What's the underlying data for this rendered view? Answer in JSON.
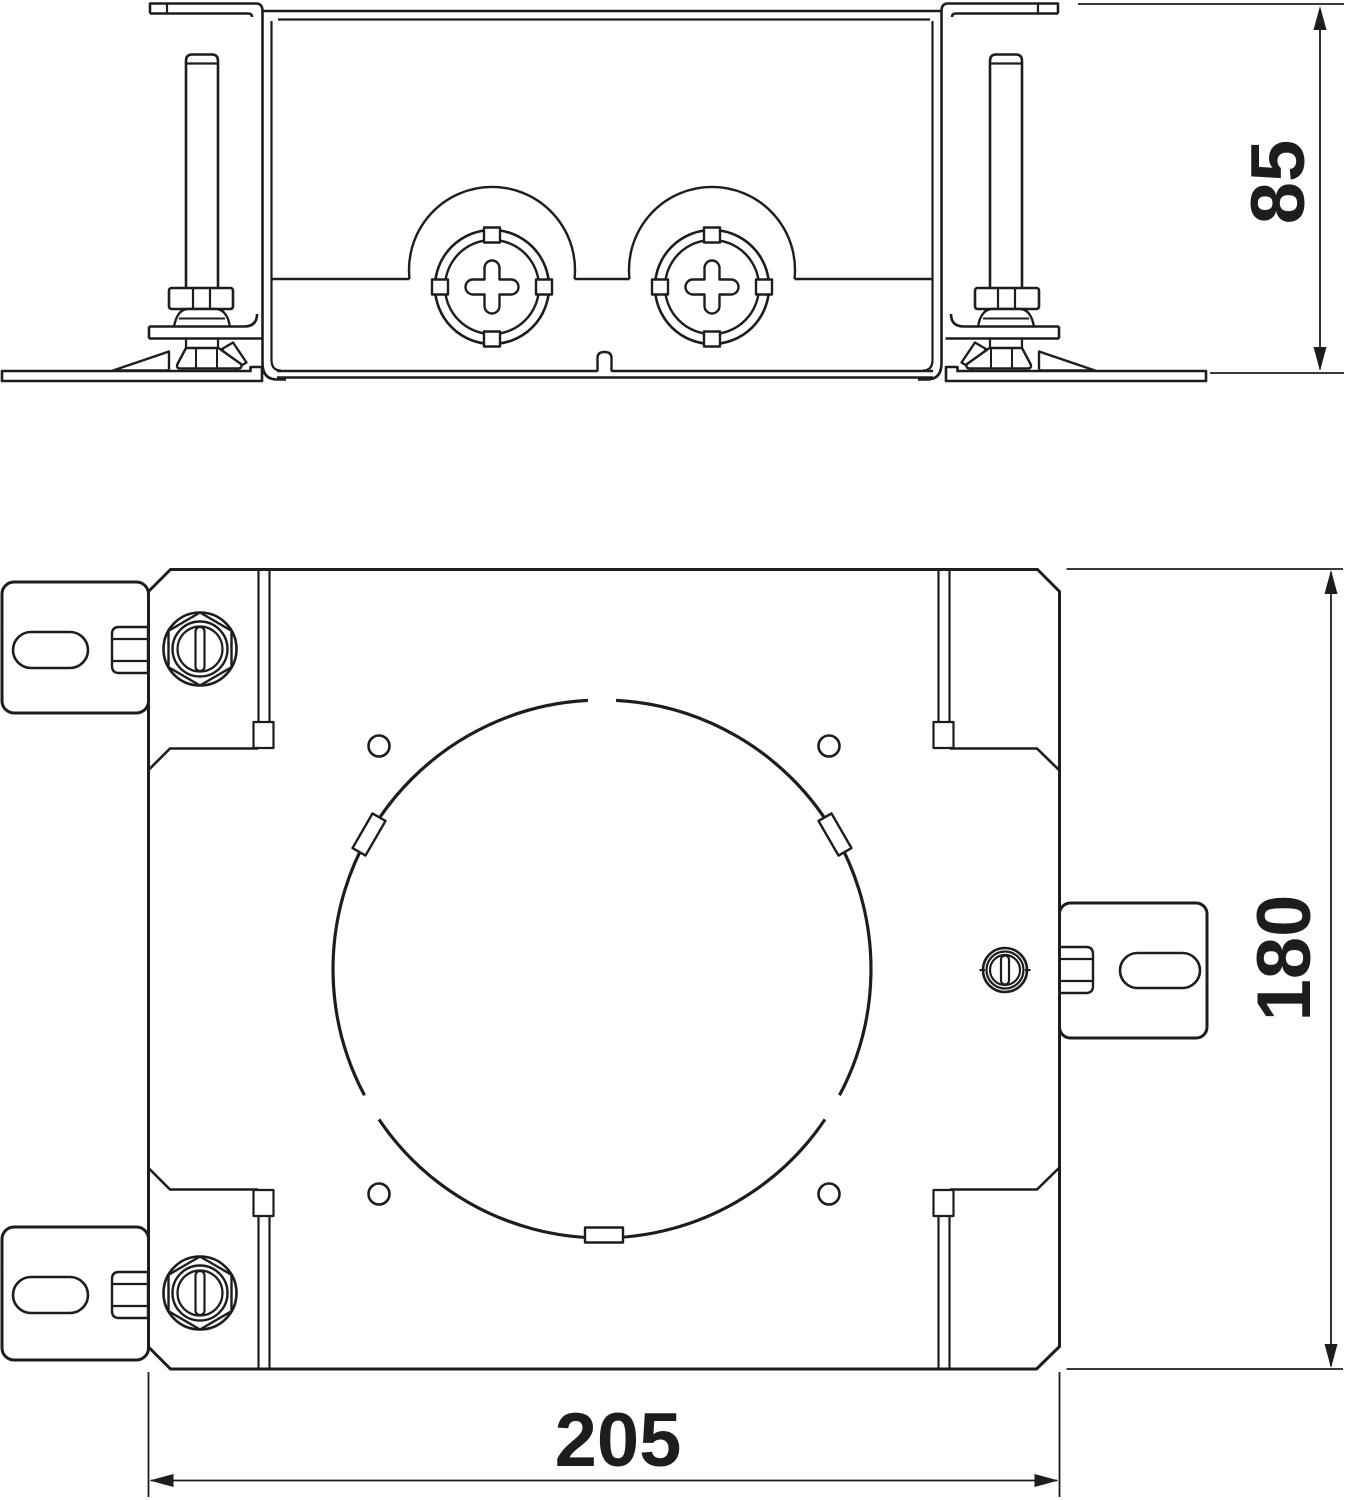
{
  "document": {
    "kind": "technical_dimension_drawing",
    "background_color": "#ffffff",
    "line_color": "#1d1d1b"
  },
  "dimensions": {
    "side_height": "85",
    "plan_height": "180",
    "plan_width": "205"
  }
}
